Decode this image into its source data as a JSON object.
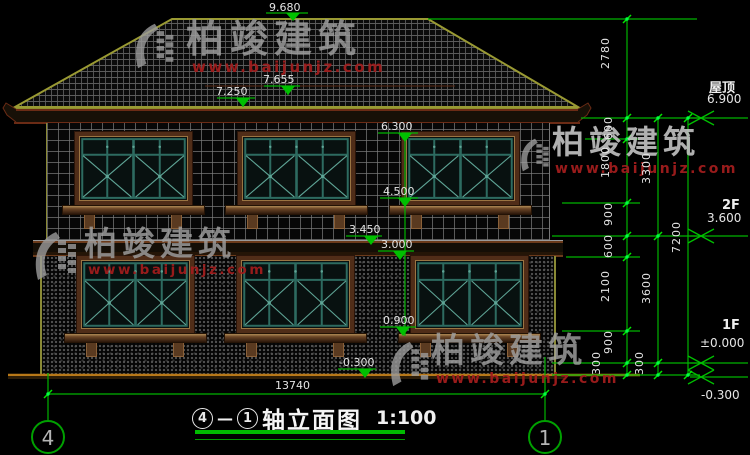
{
  "watermarks": {
    "brand": "柏竣建筑",
    "url": "www.baijunjz.com"
  },
  "elevations": {
    "ridge": "9.680",
    "roof_upper": "7.655",
    "roof_lower": "7.250",
    "f2_window_top": "6.300",
    "f2_window_sill": "4.500",
    "belt_top": "3.450",
    "belt_bottom": "3.000",
    "f1_window_sill": "0.900",
    "ground": "-0.300"
  },
  "levels": {
    "roof_label": "屋顶",
    "roof_value": "6.900",
    "f2_label": "2F",
    "f2_value": "3.600",
    "f1_label": "1F",
    "f1_value": "±0.000",
    "ground_value": "-0.300"
  },
  "dims": {
    "total_width": "13740",
    "chain1": [
      "2780",
      "600",
      "1800",
      "900",
      "600",
      "2100",
      "900",
      "300"
    ],
    "chain2": [
      "3300",
      "3600",
      "300"
    ],
    "chain3": [
      "7200"
    ]
  },
  "axes": {
    "left": "4",
    "right": "1"
  },
  "title": {
    "axis_start": "4",
    "separator": "—",
    "axis_end": "1",
    "name": "轴立面图",
    "scale": "1:100"
  }
}
